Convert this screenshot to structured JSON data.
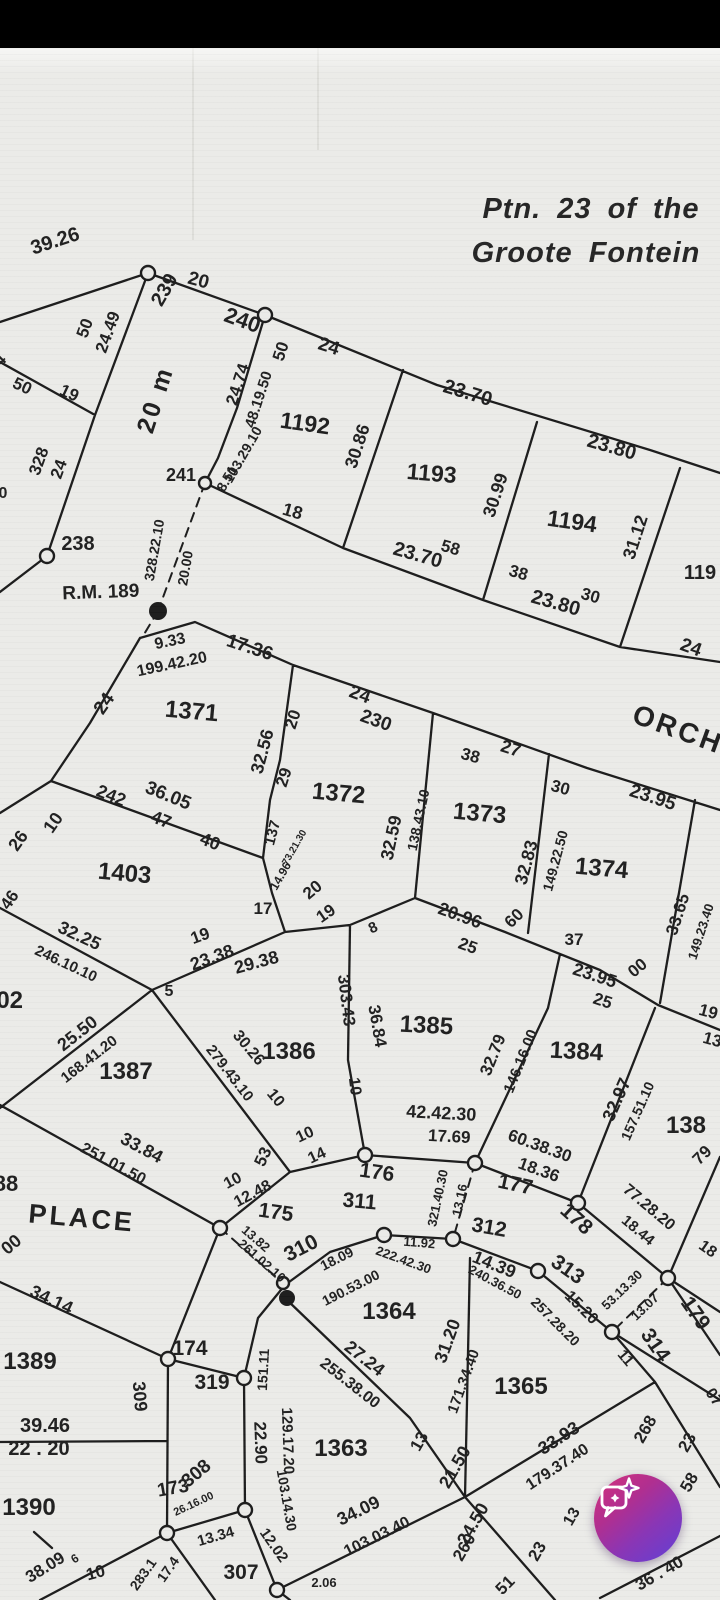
{
  "app": {
    "status_bar_color": "#000000"
  },
  "document": {
    "paper_color": "#ebebe8",
    "ink_color": "#1f1f1f",
    "title_line1": "Ptn. 23 of the",
    "title_line2": "Groote Fontein"
  },
  "map": {
    "street_names": [
      [
        "ORCH",
        675,
        738,
        20,
        28
      ],
      [
        "PLACE",
        81,
        1227,
        5,
        27
      ],
      [
        "20 m",
        163,
        402,
        -72,
        25
      ]
    ],
    "parcel_numbers": [
      [
        "1192",
        304,
        431,
        8,
        23
      ],
      [
        "1193",
        431,
        481,
        5,
        23
      ],
      [
        "1194",
        571,
        529,
        8,
        23
      ],
      [
        "119",
        700,
        579,
        0,
        20
      ],
      [
        "1371",
        191,
        719,
        5,
        24
      ],
      [
        "1372",
        338,
        801,
        5,
        24
      ],
      [
        "1373",
        479,
        821,
        5,
        24
      ],
      [
        "1374",
        601,
        876,
        5,
        24
      ],
      [
        "1403",
        124,
        881,
        5,
        24
      ],
      [
        "402",
        3,
        1008,
        0,
        24
      ],
      [
        "1385",
        426,
        1033,
        3,
        24
      ],
      [
        "1386",
        289,
        1059,
        0,
        24
      ],
      [
        "1384",
        576,
        1059,
        3,
        24
      ],
      [
        "1387",
        126,
        1079,
        0,
        24
      ],
      [
        "138",
        686,
        1133,
        0,
        24
      ],
      [
        "88",
        6,
        1191,
        0,
        22
      ],
      [
        "1389",
        30,
        1369,
        0,
        24
      ],
      [
        "1390",
        29,
        1515,
        0,
        24
      ],
      [
        "1364",
        389,
        1319,
        0,
        24
      ],
      [
        "1365",
        521,
        1394,
        0,
        24
      ],
      [
        "1363",
        341,
        1456,
        0,
        24
      ]
    ],
    "beacon_numbers": [
      [
        "238",
        78,
        550,
        0,
        20
      ],
      [
        "239",
        170,
        293,
        -60,
        20
      ],
      [
        "240",
        240,
        327,
        20,
        22
      ],
      [
        "241",
        181,
        481,
        0,
        18
      ],
      [
        "230",
        374,
        726,
        20,
        19
      ],
      [
        "174",
        190,
        1355,
        0,
        21
      ],
      [
        "175",
        275,
        1219,
        8,
        21
      ],
      [
        "176",
        376,
        1179,
        8,
        21
      ],
      [
        "177",
        514,
        1191,
        12,
        21
      ],
      [
        "178",
        572,
        1224,
        42,
        21
      ],
      [
        "179",
        690,
        1317,
        55,
        21
      ],
      [
        "307",
        241,
        1579,
        0,
        21
      ],
      [
        "308",
        200,
        1478,
        -40,
        19
      ],
      [
        "309",
        134,
        1397,
        85,
        18
      ],
      [
        "310",
        304,
        1254,
        -27,
        21
      ],
      [
        "311",
        359,
        1208,
        5,
        21
      ],
      [
        "312",
        488,
        1234,
        10,
        21
      ],
      [
        "313",
        564,
        1275,
        35,
        21
      ],
      [
        "314",
        650,
        1349,
        55,
        21
      ],
      [
        "319",
        212,
        1389,
        0,
        21
      ],
      [
        "173",
        174,
        1494,
        -10,
        19
      ]
    ],
    "dimensions": [
      [
        "39.26",
        57,
        247,
        -18,
        20
      ],
      [
        "20",
        197,
        286,
        15,
        19
      ],
      [
        "24",
        327,
        352,
        18,
        19
      ],
      [
        "23.70",
        466,
        399,
        17,
        20
      ],
      [
        "23.80",
        610,
        453,
        16,
        20
      ],
      [
        "50",
        286,
        353,
        -72,
        17
      ],
      [
        "24.74",
        243,
        386,
        -72,
        17
      ],
      [
        "48.19.50",
        263,
        401,
        -72,
        15
      ],
      [
        "50",
        90,
        330,
        -70,
        17
      ],
      [
        "24.49",
        113,
        334,
        -70,
        17
      ],
      [
        "50",
        20,
        391,
        25,
        17
      ],
      [
        "19",
        67,
        398,
        25,
        17
      ],
      [
        "4",
        4,
        364,
        -45,
        17
      ],
      [
        "328",
        44,
        463,
        -70,
        17
      ],
      [
        "24",
        64,
        471,
        -70,
        17
      ],
      [
        "0",
        3,
        498,
        0,
        16
      ],
      [
        "328.22.10",
        159,
        551,
        -80,
        14
      ],
      [
        "20.00",
        190,
        569,
        -80,
        14
      ],
      [
        "R.M. 189",
        101,
        598,
        -2,
        19
      ],
      [
        "103.29.10",
        247,
        457,
        -60,
        14
      ],
      [
        "8.51",
        231,
        481,
        -60,
        14
      ],
      [
        "18",
        291,
        517,
        16,
        18
      ],
      [
        "30.86",
        363,
        448,
        -72,
        18
      ],
      [
        "23.70",
        416,
        561,
        16,
        20
      ],
      [
        "58",
        449,
        553,
        16,
        17
      ],
      [
        "38",
        517,
        578,
        16,
        17
      ],
      [
        "30.99",
        501,
        497,
        -72,
        18
      ],
      [
        "23.80",
        554,
        609,
        16,
        20
      ],
      [
        "30",
        589,
        601,
        16,
        17
      ],
      [
        "31.12",
        641,
        539,
        -72,
        18
      ],
      [
        "24",
        689,
        653,
        20,
        19
      ],
      [
        "9.33",
        171,
        646,
        -12,
        16
      ],
      [
        "199.42.20",
        173,
        669,
        -12,
        16
      ],
      [
        "17.36",
        248,
        653,
        18,
        19
      ],
      [
        "24",
        109,
        707,
        -55,
        19
      ],
      [
        "242",
        109,
        801,
        22,
        18
      ],
      [
        "36.05",
        166,
        801,
        22,
        19
      ],
      [
        "47",
        159,
        825,
        22,
        18
      ],
      [
        "40",
        208,
        847,
        22,
        18
      ],
      [
        "26",
        23,
        844,
        -55,
        18
      ],
      [
        "10",
        58,
        826,
        -55,
        18
      ],
      [
        "32.56",
        268,
        753,
        -75,
        18
      ],
      [
        "20",
        298,
        721,
        -72,
        17
      ],
      [
        "29",
        289,
        779,
        -72,
        17
      ],
      [
        "137",
        277,
        834,
        -75,
        15
      ],
      [
        "73.21.30",
        297,
        849,
        -60,
        10
      ],
      [
        "14.96",
        284,
        878,
        -60,
        12
      ],
      [
        "32.59",
        397,
        839,
        -78,
        18
      ],
      [
        "138.43.10",
        423,
        821,
        -78,
        14
      ],
      [
        "24",
        358,
        700,
        20,
        19
      ],
      [
        "38",
        469,
        761,
        15,
        17
      ],
      [
        "27",
        509,
        754,
        18,
        18
      ],
      [
        "30",
        559,
        793,
        15,
        17
      ],
      [
        "23.95",
        651,
        803,
        18,
        19
      ],
      [
        "32.83",
        532,
        864,
        -75,
        18
      ],
      [
        "149.22.50",
        560,
        862,
        -75,
        14
      ],
      [
        "33.65",
        683,
        916,
        -72,
        17
      ],
      [
        "149.23.40",
        705,
        933,
        -72,
        13
      ],
      [
        "17",
        263,
        914,
        0,
        17
      ],
      [
        "19",
        202,
        941,
        -20,
        17
      ],
      [
        "23.38",
        214,
        963,
        -20,
        18
      ],
      [
        "29.38",
        258,
        968,
        -15,
        18
      ],
      [
        "5",
        169,
        996,
        0,
        16
      ],
      [
        "20",
        316,
        894,
        -40,
        17
      ],
      [
        "19",
        329,
        918,
        -35,
        17
      ],
      [
        "8",
        375,
        932,
        -25,
        15
      ],
      [
        "20.96",
        458,
        921,
        20,
        18
      ],
      [
        "25",
        466,
        951,
        20,
        17
      ],
      [
        "60",
        518,
        922,
        -45,
        17
      ],
      [
        "37",
        574,
        945,
        0,
        17
      ],
      [
        "23.95",
        593,
        981,
        18,
        18
      ],
      [
        "25",
        601,
        1006,
        18,
        17
      ],
      [
        "00",
        641,
        972,
        -40,
        17
      ],
      [
        "19",
        707,
        1017,
        15,
        17
      ],
      [
        "13",
        711,
        1045,
        15,
        17
      ],
      [
        "303.43",
        341,
        1001,
        83,
        17
      ],
      [
        "10",
        350,
        1087,
        83,
        16
      ],
      [
        "36.84",
        372,
        1027,
        80,
        17
      ],
      [
        "42.42.30",
        441,
        1119,
        3,
        18
      ],
      [
        "17.69",
        449,
        1142,
        3,
        17
      ],
      [
        "30.26",
        245,
        1051,
        50,
        16
      ],
      [
        "279.43.10",
        226,
        1076,
        52,
        15
      ],
      [
        "10",
        272,
        1101,
        50,
        16
      ],
      [
        "25.50",
        81,
        1038,
        -38,
        18
      ],
      [
        "168.41.20",
        92,
        1063,
        -38,
        15
      ],
      [
        "46",
        14,
        903,
        -55,
        17
      ],
      [
        "32.25",
        77,
        941,
        25,
        18
      ],
      [
        "246.10.10",
        64,
        968,
        25,
        15
      ],
      [
        "251.01.50",
        111,
        1168,
        28,
        16
      ],
      [
        "33.84",
        139,
        1153,
        28,
        18
      ],
      [
        "00",
        15,
        1249,
        -40,
        18
      ],
      [
        "34.14",
        49,
        1305,
        25,
        18
      ],
      [
        "32.79",
        498,
        1057,
        -68,
        17
      ],
      [
        "146.16.00",
        525,
        1063,
        -68,
        15
      ],
      [
        "60.38.30",
        538,
        1151,
        20,
        17
      ],
      [
        "18.36",
        537,
        1175,
        20,
        17
      ],
      [
        "32.97",
        622,
        1102,
        -66,
        18
      ],
      [
        "157.51.10",
        642,
        1113,
        -66,
        14
      ],
      [
        "77.28.20",
        646,
        1211,
        40,
        16
      ],
      [
        "18.44",
        635,
        1234,
        40,
        15
      ],
      [
        "79",
        706,
        1159,
        -45,
        17
      ],
      [
        "18",
        705,
        1253,
        35,
        16
      ],
      [
        "53",
        268,
        1159,
        -65,
        17
      ],
      [
        "10",
        307,
        1139,
        -25,
        16
      ],
      [
        "14",
        319,
        1160,
        -25,
        16
      ],
      [
        "10",
        235,
        1185,
        -28,
        16
      ],
      [
        "12.48",
        255,
        1198,
        -28,
        16
      ],
      [
        "321.40.30",
        442,
        1199,
        -78,
        13
      ],
      [
        "13.16",
        464,
        1201,
        -78,
        13
      ],
      [
        "11.92",
        419,
        1247,
        5,
        13
      ],
      [
        "14.39",
        492,
        1270,
        22,
        18
      ],
      [
        "222.42.30",
        402,
        1264,
        20,
        13
      ],
      [
        "240.36.50",
        493,
        1286,
        28,
        13
      ],
      [
        "18.09",
        339,
        1263,
        -27,
        14
      ],
      [
        "190.53.00",
        353,
        1292,
        -27,
        14
      ],
      [
        "13.82",
        253,
        1242,
        41,
        13
      ],
      [
        "261.02.10",
        259,
        1264,
        41,
        13
      ],
      [
        "15.20",
        578,
        1311,
        45,
        16
      ],
      [
        "257.28.20",
        552,
        1325,
        45,
        14
      ],
      [
        "53.13.30",
        625,
        1293,
        -44,
        13
      ],
      [
        "13.07",
        648,
        1310,
        -44,
        13
      ],
      [
        "11",
        622,
        1361,
        50,
        15
      ],
      [
        "07",
        710,
        1400,
        55,
        16
      ],
      [
        "151.11",
        268,
        1370,
        -87,
        14
      ],
      [
        "22.90",
        255,
        1443,
        88,
        17
      ],
      [
        "129.17.20",
        283,
        1441,
        88,
        15
      ],
      [
        "27.24",
        361,
        1363,
        38,
        18
      ],
      [
        "255.38.00",
        347,
        1387,
        38,
        16
      ],
      [
        "31.20",
        453,
        1343,
        -70,
        18
      ],
      [
        "171.34.40",
        468,
        1383,
        -70,
        15
      ],
      [
        "13",
        424,
        1444,
        -60,
        17
      ],
      [
        "21.50",
        460,
        1470,
        -60,
        18
      ],
      [
        "24.50",
        478,
        1527,
        -60,
        18
      ],
      [
        "260",
        469,
        1550,
        -60,
        17
      ],
      [
        "23",
        542,
        1554,
        -60,
        17
      ],
      [
        "51",
        509,
        1589,
        -45,
        17
      ],
      [
        "13",
        576,
        1519,
        -60,
        16
      ],
      [
        "268",
        650,
        1432,
        -60,
        17
      ],
      [
        "23",
        692,
        1445,
        -60,
        17
      ],
      [
        "58",
        694,
        1485,
        -60,
        17
      ],
      [
        "36 . 40",
        662,
        1578,
        -30,
        17
      ],
      [
        "33.93",
        562,
        1443,
        -33,
        18
      ],
      [
        "179.37.40",
        560,
        1471,
        -33,
        16
      ],
      [
        "34.09",
        361,
        1516,
        -26,
        18
      ],
      [
        "103.03.40",
        379,
        1541,
        -26,
        16
      ],
      [
        "103.14.30",
        282,
        1501,
        80,
        14
      ],
      [
        "12.02",
        270,
        1548,
        55,
        15
      ],
      [
        "2.06",
        324,
        1587,
        0,
        13
      ],
      [
        "13.34",
        217,
        1541,
        -16,
        15
      ],
      [
        "26.16.00",
        195,
        1507,
        -25,
        11
      ],
      [
        "39.46",
        45,
        1432,
        0,
        20
      ],
      [
        "22 . 20",
        39,
        1455,
        0,
        20
      ],
      [
        "38.09",
        48,
        1572,
        -32,
        17
      ],
      [
        "6",
        77,
        1562,
        -32,
        12
      ],
      [
        "10",
        97,
        1578,
        -15,
        17
      ],
      [
        "283.1",
        147,
        1577,
        -55,
        14
      ],
      [
        "17.4",
        172,
        1572,
        -55,
        14
      ]
    ]
  },
  "fab": {
    "icon": "chat-sparkle",
    "gradient_start": "#d5307c",
    "gradient_mid": "#8a36b5",
    "gradient_end": "#6040d6"
  }
}
